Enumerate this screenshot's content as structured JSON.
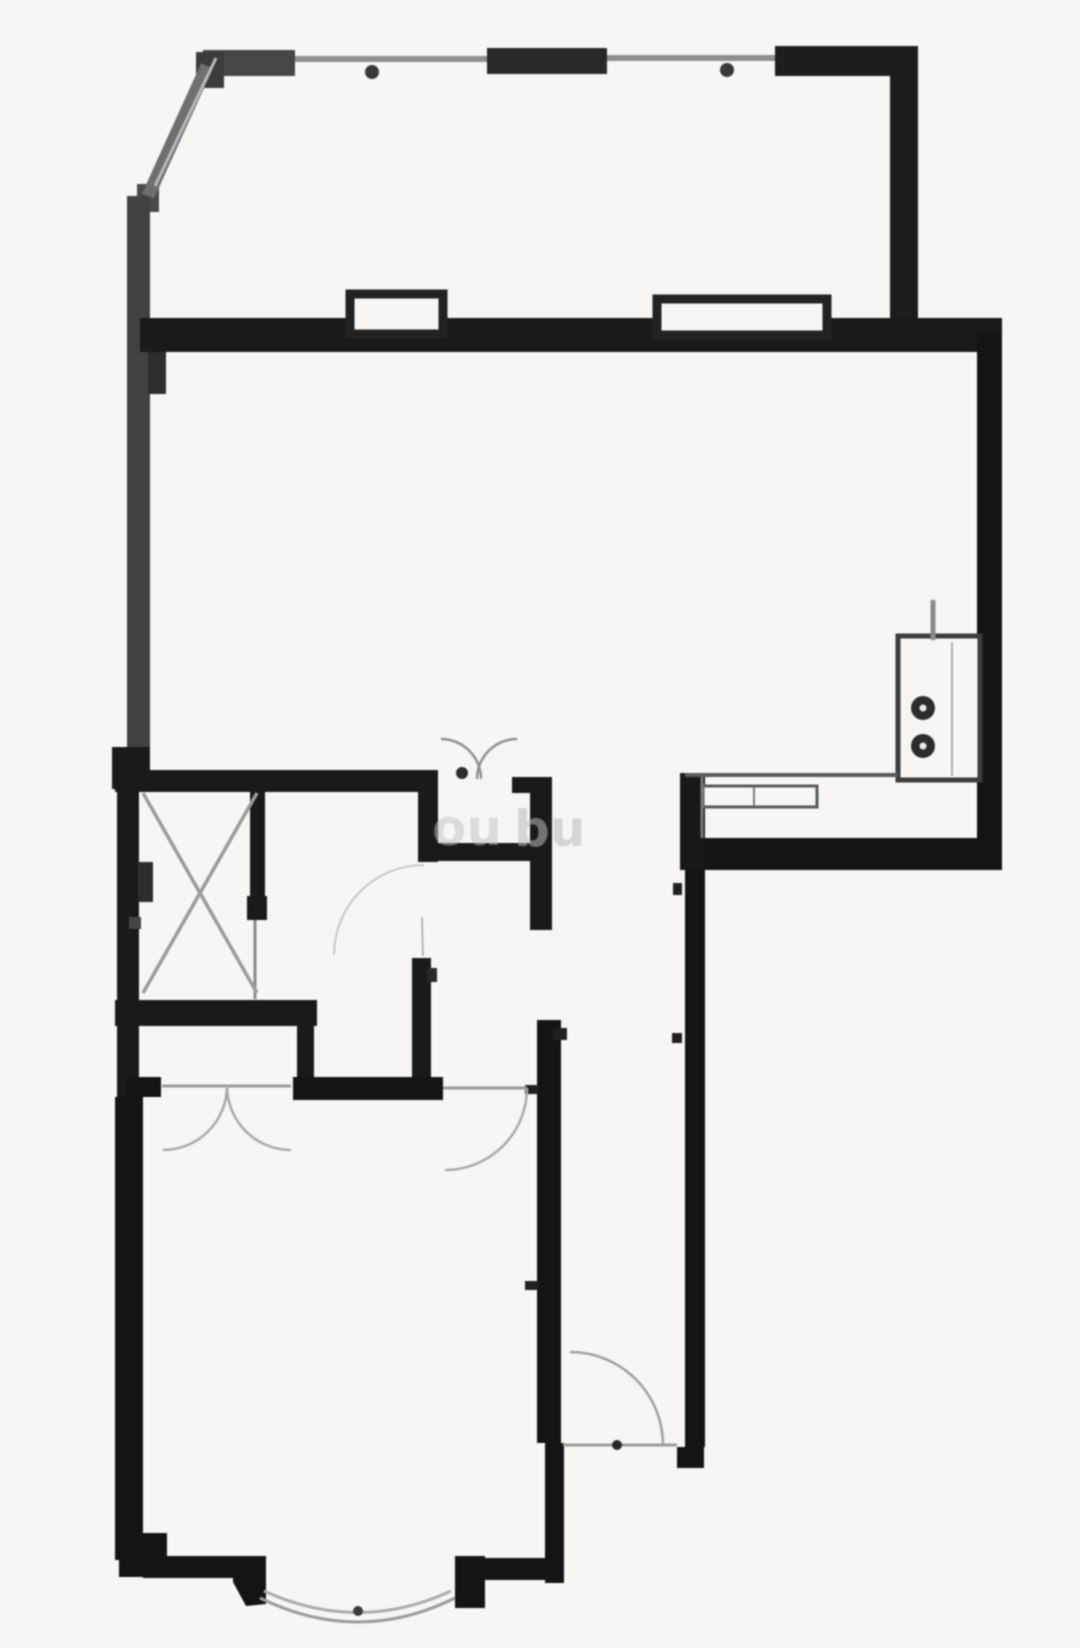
{
  "canvas": {
    "w": 1080,
    "h": 1648,
    "bg": "#f5f4f2",
    "ink": "#1a1a1a"
  },
  "plan": {
    "rects": [
      {
        "n": "balcony-top-wall-left",
        "x": 203,
        "y": 50,
        "w": 92,
        "h": 26,
        "c": "#474747"
      },
      {
        "n": "balcony-top-corner",
        "x": 196,
        "y": 52,
        "w": 28,
        "h": 36,
        "c": "#3d3d3d"
      },
      {
        "n": "balcony-top-wall-mid",
        "x": 487,
        "y": 48,
        "w": 120,
        "h": 26,
        "c": "#2b2b2b"
      },
      {
        "n": "balcony-top-wall-right",
        "x": 775,
        "y": 46,
        "w": 143,
        "h": 30,
        "c": "#1f1f1f"
      },
      {
        "n": "balcony-right-wall",
        "x": 890,
        "y": 46,
        "w": 28,
        "h": 292,
        "c": "#1f1f1f"
      },
      {
        "n": "diagonal-end-block",
        "x": 137,
        "y": 184,
        "w": 22,
        "h": 28,
        "c": "#4a4a4a"
      },
      {
        "n": "left-exterior-wall",
        "x": 127,
        "y": 196,
        "w": 23,
        "h": 585,
        "c": "#424242"
      },
      {
        "n": "left-wall-pier-top",
        "x": 148,
        "y": 348,
        "w": 18,
        "h": 46,
        "c": "#2f2f2f"
      },
      {
        "n": "main-cross-wall",
        "x": 140,
        "y": 318,
        "w": 862,
        "h": 34,
        "c": "#1c1c1c"
      },
      {
        "n": "right-exterior-wall",
        "x": 977,
        "y": 333,
        "w": 25,
        "h": 537,
        "c": "#161616"
      },
      {
        "n": "kitchen-south-wall",
        "x": 698,
        "y": 838,
        "w": 304,
        "h": 32,
        "c": "#161616"
      },
      {
        "n": "kitchen-west-stub",
        "x": 680,
        "y": 773,
        "w": 25,
        "h": 97,
        "c": "#1a1a1a"
      },
      {
        "n": "hall-east-wall",
        "x": 685,
        "y": 870,
        "w": 20,
        "h": 577,
        "c": "#161616"
      },
      {
        "n": "hall-east-wall-foot",
        "x": 677,
        "y": 1447,
        "w": 27,
        "h": 21,
        "c": "#161616"
      },
      {
        "n": "lowerleft-top-wall",
        "x": 115,
        "y": 770,
        "w": 323,
        "h": 22,
        "c": "#1c1c1c"
      },
      {
        "n": "lowerleft-corner-block",
        "x": 112,
        "y": 747,
        "w": 38,
        "h": 42,
        "c": "#1c1c1c"
      },
      {
        "n": "west-wall-lower",
        "x": 117,
        "y": 789,
        "w": 22,
        "h": 308,
        "c": "#1c1c1c"
      },
      {
        "n": "bath-east-wall-upper",
        "x": 418,
        "y": 782,
        "w": 20,
        "h": 80,
        "c": "#1c1c1c"
      },
      {
        "n": "bath-east-wall-lower",
        "x": 412,
        "y": 958,
        "w": 19,
        "h": 139,
        "c": "#1c1c1c"
      },
      {
        "n": "bath-east-tick",
        "x": 427,
        "y": 968,
        "w": 10,
        "h": 14,
        "c": "#2a2a2a"
      },
      {
        "n": "vestibule-south-wall",
        "x": 438,
        "y": 843,
        "w": 114,
        "h": 18,
        "c": "#1c1c1c"
      },
      {
        "n": "vestibule-east-wall",
        "x": 530,
        "y": 790,
        "w": 22,
        "h": 140,
        "c": "#1c1c1c"
      },
      {
        "n": "vestibule-east-wall-top",
        "x": 512,
        "y": 777,
        "w": 40,
        "h": 16,
        "c": "#1c1c1c"
      },
      {
        "n": "hall-west-wall",
        "x": 537,
        "y": 1020,
        "w": 24,
        "h": 423,
        "c": "#161616"
      },
      {
        "n": "hall-west-wall-foot",
        "x": 545,
        "y": 1443,
        "w": 19,
        "h": 140,
        "c": "#161616"
      },
      {
        "n": "hall-west-tick-upper",
        "x": 553,
        "y": 1028,
        "w": 14,
        "h": 12,
        "c": "#222222"
      },
      {
        "n": "hall-west-tick-mid",
        "x": 525,
        "y": 1085,
        "w": 14,
        "h": 9,
        "c": "#222222"
      },
      {
        "n": "hall-west-tick-lower",
        "x": 525,
        "y": 1281,
        "w": 14,
        "h": 9,
        "c": "#222222"
      },
      {
        "n": "hall-east-tick",
        "x": 672,
        "y": 1033,
        "w": 10,
        "h": 10,
        "c": "#222222"
      },
      {
        "n": "hall-east-notch",
        "x": 673,
        "y": 883,
        "w": 9,
        "h": 12,
        "c": "#222222"
      },
      {
        "n": "closet-east-wall",
        "x": 250,
        "y": 790,
        "w": 15,
        "h": 114,
        "c": "#1c1c1c"
      },
      {
        "n": "closet-east-wall-end",
        "x": 247,
        "y": 896,
        "w": 20,
        "h": 24,
        "c": "#1c1c1c"
      },
      {
        "n": "closet-south-wall",
        "x": 115,
        "y": 1000,
        "w": 202,
        "h": 26,
        "c": "#1c1c1c"
      },
      {
        "n": "bath-west-wall",
        "x": 297,
        "y": 1002,
        "w": 17,
        "h": 98,
        "c": "#1c1c1c"
      },
      {
        "n": "hall-north-wall",
        "x": 293,
        "y": 1077,
        "w": 150,
        "h": 23,
        "c": "#161616"
      },
      {
        "n": "bedroom-closet-stub",
        "x": 126,
        "y": 1077,
        "w": 35,
        "h": 20,
        "c": "#161616"
      },
      {
        "n": "left-wall-pier-mid",
        "x": 138,
        "y": 862,
        "w": 15,
        "h": 40,
        "c": "#303030"
      },
      {
        "n": "left-wall-tick",
        "x": 129,
        "y": 917,
        "w": 12,
        "h": 12,
        "c": "#454545"
      },
      {
        "n": "bedroom-west-wall",
        "x": 115,
        "y": 1097,
        "w": 28,
        "h": 463,
        "c": "#161616"
      },
      {
        "n": "bedroom-sw-block",
        "x": 119,
        "y": 1533,
        "w": 48,
        "h": 44,
        "c": "#161616"
      },
      {
        "n": "bedroom-south-wall-left",
        "x": 143,
        "y": 1556,
        "w": 114,
        "h": 22,
        "c": "#161616"
      },
      {
        "n": "bay-corner-right-block",
        "x": 455,
        "y": 1556,
        "w": 30,
        "h": 52,
        "c": "#161616"
      },
      {
        "n": "bedroom-south-wall-right",
        "x": 483,
        "y": 1558,
        "w": 76,
        "h": 22,
        "c": "#161616"
      }
    ],
    "polys": [
      {
        "n": "bay-corner-left-block",
        "pts": "233,1556 266,1556 266,1604 246,1606 233,1582",
        "c": "#161616"
      }
    ],
    "boxes": [
      {
        "n": "window-box-left",
        "x": 350,
        "y": 294,
        "w": 93,
        "h": 40,
        "sw": 9,
        "c": "#242424"
      },
      {
        "n": "window-box-right",
        "x": 657,
        "y": 299,
        "w": 170,
        "h": 36,
        "sw": 9,
        "c": "#242424"
      },
      {
        "n": "kitchen-unit",
        "x": 898,
        "y": 636,
        "w": 82,
        "h": 144,
        "sw": 5,
        "c": "#3d3d3d"
      },
      {
        "n": "kitchen-sink",
        "x": 703,
        "y": 786,
        "w": 114,
        "h": 21,
        "sw": 3,
        "c": "#5a5a5a"
      }
    ],
    "lines": [
      {
        "n": "balcony-window-diagonal",
        "x1": 207,
        "y1": 66,
        "x2": 148,
        "y2": 196,
        "w": 13,
        "c": "#6f6f6f"
      },
      {
        "n": "balcony-window-diagonal-inner",
        "x1": 216,
        "y1": 58,
        "x2": 155,
        "y2": 186,
        "w": 3,
        "c": "#b8b8b8"
      },
      {
        "n": "balcony-window-line-left",
        "x1": 295,
        "y1": 59,
        "x2": 487,
        "y2": 59,
        "w": 6,
        "c": "#8f8f8f"
      },
      {
        "n": "balcony-window-line-right",
        "x1": 607,
        "y1": 58,
        "x2": 775,
        "y2": 58,
        "w": 6,
        "c": "#8f8f8f"
      },
      {
        "n": "kitchen-counter-front",
        "x1": 685,
        "y1": 775,
        "x2": 898,
        "y2": 775,
        "w": 4,
        "c": "#5a5a5a"
      },
      {
        "n": "kitchen-counter-left-edge",
        "x1": 702,
        "y1": 777,
        "x2": 702,
        "y2": 838,
        "w": 3,
        "c": "#7a7a7a"
      },
      {
        "n": "kitchen-sink-divider",
        "x1": 754,
        "y1": 787,
        "x2": 754,
        "y2": 806,
        "w": 2,
        "c": "#7a7a7a"
      },
      {
        "n": "kitchen-unit-inner-line",
        "x1": 952,
        "y1": 642,
        "x2": 952,
        "y2": 776,
        "w": 2,
        "c": "#b0b0b0"
      },
      {
        "n": "kitchen-unit-tick",
        "x1": 933,
        "y1": 600,
        "x2": 933,
        "y2": 640,
        "w": 5,
        "c": "#8a8a8a"
      },
      {
        "n": "closet-door-line",
        "x1": 255,
        "y1": 920,
        "x2": 255,
        "y2": 999,
        "w": 3,
        "c": "#8a8a8a"
      },
      {
        "n": "closet-doors-threshold",
        "x1": 162,
        "y1": 1086,
        "x2": 291,
        "y2": 1086,
        "w": 3,
        "c": "#9a9a9a"
      },
      {
        "n": "bedroom-door-threshold",
        "x1": 443,
        "y1": 1088,
        "x2": 527,
        "y2": 1088,
        "w": 3,
        "c": "#9a9a9a"
      },
      {
        "n": "entry-door-threshold",
        "x1": 563,
        "y1": 1445,
        "x2": 677,
        "y2": 1445,
        "w": 3,
        "c": "#9a9a9a"
      },
      {
        "n": "bath-door-line",
        "x1": 422,
        "y1": 917,
        "x2": 423,
        "y2": 956,
        "w": 2,
        "c": "#b5b5b5"
      },
      {
        "n": "closet-x-line-1",
        "x1": 143,
        "y1": 793,
        "x2": 257,
        "y2": 993,
        "w": 3.5,
        "c": "#9a9a9a"
      },
      {
        "n": "closet-x-line-2",
        "x1": 257,
        "y1": 793,
        "x2": 143,
        "y2": 993,
        "w": 3.5,
        "c": "#9a9a9a"
      }
    ],
    "paths": [
      {
        "n": "livingroom-door-arc-left",
        "d": "M 481,779 A 40 40 0 0 0 441,739",
        "w": 2.5,
        "c": "#8f8f8f"
      },
      {
        "n": "livingroom-door-arc-right",
        "d": "M 477,779 A 40 40 0 0 1 517,739",
        "w": 2.5,
        "c": "#8f8f8f"
      },
      {
        "n": "bath-door-arc",
        "d": "M 424,865 A 90 90 0 0 0 334,955",
        "w": 2,
        "c": "#c6c6c6"
      },
      {
        "n": "closet-door-arc-left",
        "d": "M 227,1086 A 64 64 0 0 1 163,1150",
        "w": 2.5,
        "c": "#a8a8a8"
      },
      {
        "n": "closet-door-arc-right",
        "d": "M 227,1086 A 64 64 0 0 0 291,1150",
        "w": 2.5,
        "c": "#a8a8a8"
      },
      {
        "n": "bedroom-door-arc",
        "d": "M 527,1088 A 82 82 0 0 1 445,1170",
        "w": 2.5,
        "c": "#a8a8a8"
      },
      {
        "n": "entry-door-arc",
        "d": "M 570,1352 A 93 93 0 0 1 663,1445",
        "w": 2.5,
        "c": "#9f9f9f"
      },
      {
        "n": "bay-window-arc-outer",
        "d": "M 260,1598 Q 358,1646 455,1598",
        "w": 3,
        "c": "#9a9a9a"
      },
      {
        "n": "bay-window-arc-inner",
        "d": "M 264,1591 Q 358,1634 451,1591",
        "w": 3,
        "c": "#ababab"
      }
    ],
    "circles": [
      {
        "n": "stove-burner-1",
        "cx": 923,
        "cy": 708,
        "r": 12,
        "f": "#2e2e2e"
      },
      {
        "n": "stove-burner-1-center",
        "cx": 923,
        "cy": 708,
        "r": 3.5,
        "f": "#e8e8e8"
      },
      {
        "n": "stove-burner-2",
        "cx": 923,
        "cy": 746,
        "r": 12,
        "f": "#2e2e2e"
      },
      {
        "n": "stove-burner-2-center",
        "cx": 923,
        "cy": 746,
        "r": 3.5,
        "f": "#e8e8e8"
      },
      {
        "n": "window-post-left",
        "cx": 372,
        "cy": 72,
        "r": 7,
        "f": "#3a3a3a"
      },
      {
        "n": "window-post-right",
        "cx": 727,
        "cy": 70,
        "r": 7,
        "f": "#3a3a3a"
      },
      {
        "n": "livingroom-door-hinge-dot",
        "cx": 462,
        "cy": 773,
        "r": 6,
        "f": "#2e2e2e"
      },
      {
        "n": "bay-window-dot",
        "cx": 358,
        "cy": 1611,
        "r": 5,
        "f": "#3a3a3a"
      },
      {
        "n": "entry-door-dot",
        "cx": 617,
        "cy": 1445,
        "r": 5,
        "f": "#2a2a2a"
      }
    ],
    "watermarks": [
      {
        "n": "watermark-fragment-1",
        "t": "ou",
        "x": 432,
        "y": 845,
        "s": 50,
        "c": "#bfbfbf",
        "o": 0.5
      },
      {
        "n": "watermark-fragment-2",
        "t": "bu",
        "x": 514,
        "y": 846,
        "s": 50,
        "c": "#b9b9b9",
        "o": 0.55
      }
    ]
  }
}
